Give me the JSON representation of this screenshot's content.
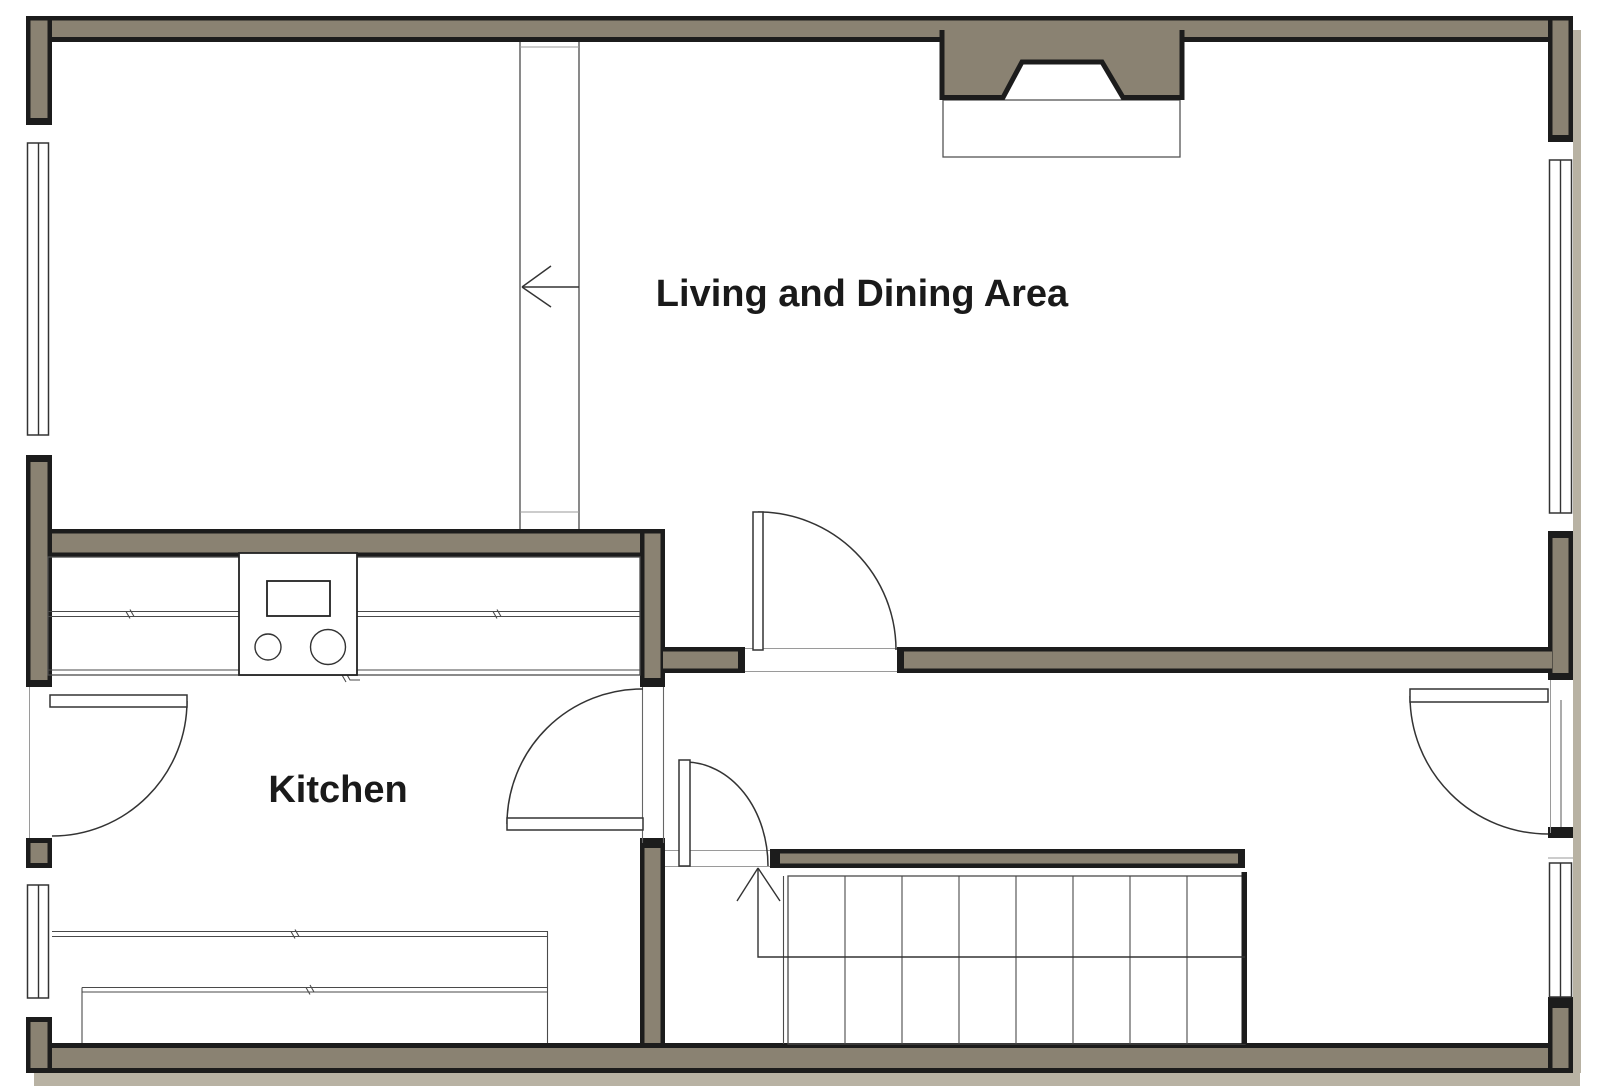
{
  "rooms": [
    {
      "id": "living-dining",
      "label": "Living and Dining Area"
    },
    {
      "id": "kitchen",
      "label": "Kitchen"
    }
  ],
  "stairs": {
    "tread_count": 8,
    "direction": "up"
  },
  "icons": {
    "stairs_direction_arrow": "arrow-up",
    "channel_direction_arrow": "arrow-left",
    "fireplace": "chimney-with-hearth",
    "stove": "cooktop-two-burners"
  },
  "colors": {
    "wall_fill": "#8a8272",
    "wall_outline": "#1c1c1c",
    "thin_line": "#4a4a4a",
    "shadow": "#b8b2a3",
    "background": "#ffffff",
    "text": "#1a1a1a"
  }
}
